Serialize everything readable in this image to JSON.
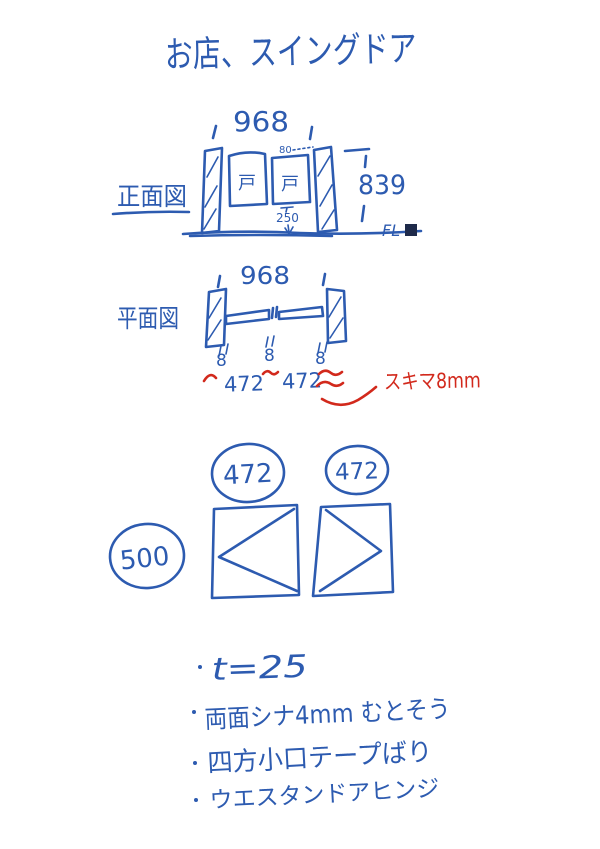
{
  "page": {
    "background": "#ffffff",
    "ink_blue": "#2d5bb0",
    "ink_red": "#d2291c",
    "fl_marker": "#1e2a4a"
  },
  "title": "お店、スイングドア",
  "front_view": {
    "label": "正面図",
    "width_dim": "968",
    "height_dim": "839",
    "left_door_label": "戸",
    "right_door_label": "戸",
    "top_gap_dim": "80",
    "bottom_clearance_dim": "250",
    "floor_label": "FL"
  },
  "plan_view": {
    "label": "平面図",
    "width_dim": "968",
    "gap_dims": [
      "8",
      "8",
      "8"
    ],
    "leaf_width_dims": [
      "472",
      "472"
    ],
    "red_note": "スキマ8mm"
  },
  "parts": {
    "leaf_width_circles": [
      "472",
      "472"
    ],
    "height_circle": "500"
  },
  "notes": [
    "t=25",
    "両面シナ4mm むとそう",
    "四方小口テープばり",
    "ウエスタンドアヒンジ"
  ]
}
